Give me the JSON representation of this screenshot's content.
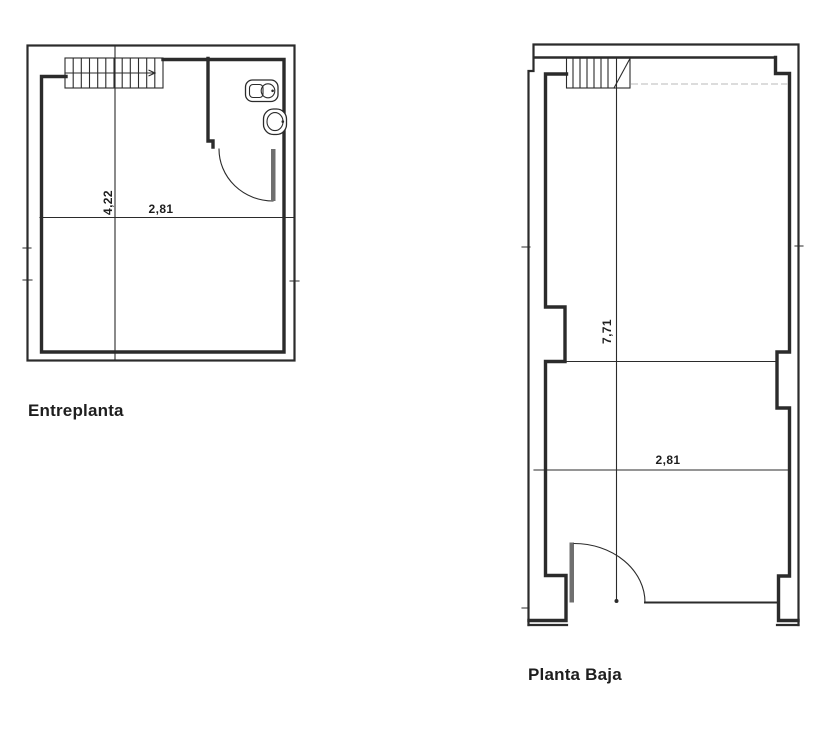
{
  "sheet": {
    "type": "architectural-floor-plan",
    "background": "#ffffff",
    "ink_color": "#2b2b2b",
    "faint_line_color": "#c7c7c7",
    "door_leaf_color": "#6f6f6f"
  },
  "plans": [
    {
      "id": "entreplanta",
      "label": "Entreplanta",
      "dimensions": {
        "vertical": "4,22",
        "horizontal": "2,81"
      },
      "features": [
        "staircase",
        "stair-direction-arrow",
        "toilet",
        "washbasin",
        "door-swing",
        "dimension-lines"
      ]
    },
    {
      "id": "planta-baja",
      "label": "Planta Baja",
      "dimensions": {
        "vertical": "7,71",
        "horizontal": "2,81"
      },
      "features": [
        "staircase",
        "upper-floor-edge-dashed",
        "wall-pilasters",
        "entrance-door-swing",
        "shopfront-threshold",
        "dimension-lines"
      ]
    }
  ]
}
